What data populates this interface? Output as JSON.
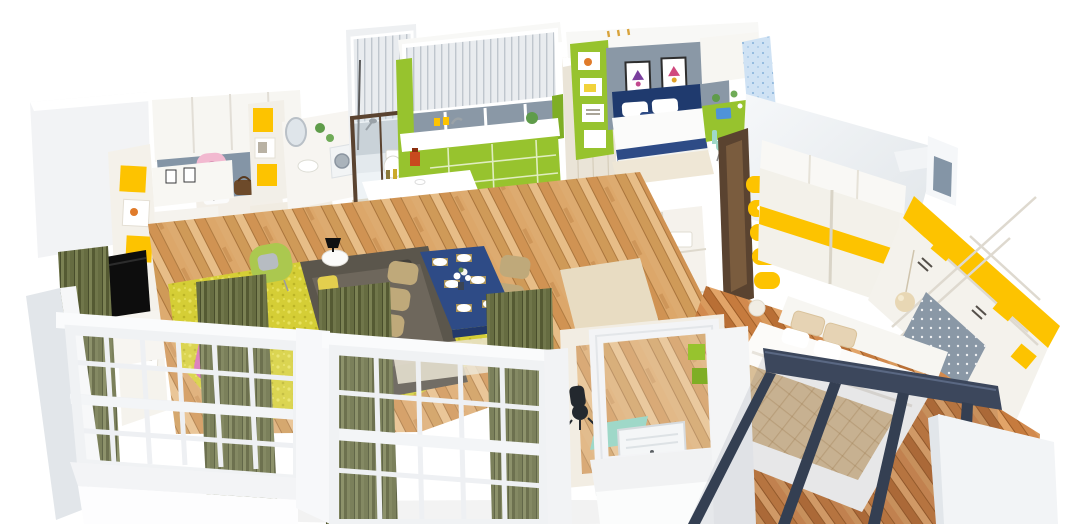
{
  "scene": {
    "title": "3D isometric apartment floor-plan render",
    "style": "cutaway dollhouse view on white background",
    "background": "#ffffff",
    "rooms": [
      {
        "id": "entry-hall",
        "label": "Entry hall",
        "items": [
          "white storage cabinets",
          "gray back panel",
          "pink backpack",
          "bench with striped pillow",
          "brown handbag",
          "yellow open shelf cubbies"
        ]
      },
      {
        "id": "living-room",
        "label": "Living room",
        "items": [
          "black wall TV",
          "white media cabinet",
          "lime green armchair",
          "dark olive sofa with yellow and teal pillows",
          "yellow shag rug",
          "white side table",
          "black table lamp",
          "oak plank floor"
        ]
      },
      {
        "id": "dining-area",
        "label": "Dining area",
        "items": [
          "navy blue dining table",
          "six khaki chairs",
          "white plates on gold mats",
          "white flower centerpiece",
          "pale area mat"
        ]
      },
      {
        "id": "kitchen",
        "label": "Kitchen",
        "items": [
          "lime green cabinets",
          "white countertop",
          "window with vertical blinds",
          "dark teal mosaic floor",
          "white breakfast bar",
          "two lime bar stools",
          "red coffee maker"
        ]
      },
      {
        "id": "bathroom-laundry",
        "label": "Bathroom and laundry",
        "items": [
          "gray striped blind",
          "dark framed glass shower",
          "white toilet",
          "round mirror vanity",
          "white basin",
          "washing machine"
        ]
      },
      {
        "id": "kids-bedroom",
        "label": "Kids bedroom",
        "items": [
          "gray accent wall",
          "two crown posters",
          "navy bed with white pillows",
          "lime shelving",
          "lime desk",
          "blue laptop",
          "mint desk chair",
          "blue dotted curtain"
        ]
      },
      {
        "id": "hallway",
        "label": "Hallway storage",
        "items": [
          "beige wardrobe column",
          "white cabinets with folded towels",
          "lime door frame"
        ]
      },
      {
        "id": "study-nook",
        "label": "Study nook",
        "items": [
          "white window frame",
          "air conditioner unit",
          "black desk chair",
          "teal mat",
          "lime wall cubes"
        ]
      },
      {
        "id": "master-bedroom",
        "label": "Master bedroom",
        "items": [
          "sliding wardrobe with yellow band",
          "yellow curved corner shelves",
          "yellow open shelving wall",
          "gray pegboard panel",
          "beige quilted bed",
          "white duvet",
          "round pendant lamp",
          "dark brown door frame",
          "orange oak floor"
        ]
      },
      {
        "id": "facade",
        "label": "Front facade",
        "items": [
          "white grid windows",
          "olive curtains",
          "pink armchair",
          "dark slate glass partition",
          "white plinth walls"
        ]
      }
    ]
  },
  "palette": {
    "wall": "#f2f3f5",
    "wallBright": "#fafbfc",
    "wallShade": "#e2e6ea",
    "lime": "#97c32e",
    "limeDark": "#7fae25",
    "limeChair": "#abc84f",
    "yellow": "#fdc300",
    "rug": "#d5ce36",
    "olive": "#666c41",
    "oliveDark": "#51562f",
    "sofa": "#5b564c",
    "navy": "#2e4b86",
    "navyDark": "#1f3a6e",
    "slate": "#8495a6",
    "slateWall": "#8a98a6",
    "tealFloor": "#45604e",
    "pink": "#f2b9d0",
    "pink2": "#d86fb4",
    "khaki": "#bfa97a",
    "beige": "#d9bf98",
    "mint": "#9fd8c8",
    "blueCurtain": "#cfe2f4",
    "laptopBlue": "#4f93d8",
    "doorBrown": "#5a4330",
    "frameDark": "#3c475c",
    "hallBeige": "#eae4d7",
    "counter": "#f7f5f1",
    "towelBlue": "#cfe4ec",
    "bg": "#ffffff"
  }
}
